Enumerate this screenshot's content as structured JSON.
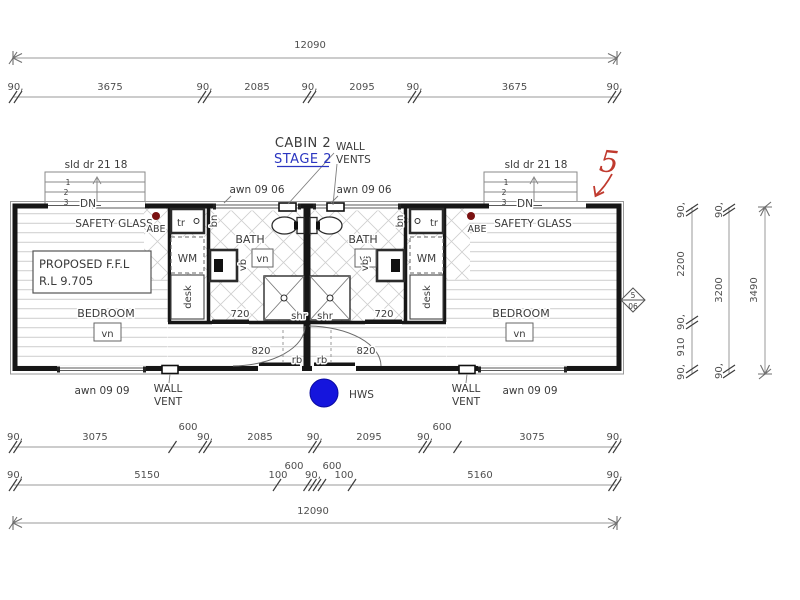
{
  "colors": {
    "stage_blue": "#2a35c0",
    "markup_red": "#c03a2e",
    "abe_dot": "#7a1111",
    "hws_blue": "#1515dd"
  },
  "dims": {
    "top_overall": "12090",
    "bottom_overall": "12090",
    "top_row": [
      "90,",
      "3675",
      "90,",
      "2085",
      "90,",
      "2095",
      "90,",
      "3675",
      "90,"
    ],
    "bottom_row1": [
      "90,",
      "3075",
      "600",
      "90,",
      "2085",
      "90,",
      "2095",
      "90,",
      "600",
      "3075",
      "90,"
    ],
    "bottom_row2": [
      "90,",
      "5150",
      "600",
      "100",
      "90,",
      "100",
      "600",
      "5160",
      "90,"
    ],
    "right_col_inner": [
      "90,",
      "2200",
      "90,",
      "910",
      "90,"
    ],
    "right_col_mid": [
      "90,",
      "3200",
      "90,"
    ],
    "right_overall": "3490"
  },
  "plan": {
    "title": "CABIN 2",
    "stage": "STAGE 2",
    "wall_vents_label": [
      "WALL",
      "VENTS"
    ],
    "sliding_door_label": "sld dr 21 18",
    "awning_top_label": "awn 09 06",
    "awning_bottom_label": "awn 09 09",
    "wall_vent_label": [
      "WALL",
      "VENT"
    ],
    "safety_glass": "SAFETY GLASS",
    "abe": "ABE",
    "down": "DN",
    "steps": [
      "1",
      "2",
      "3"
    ],
    "ffl_line1": "PROPOSED F.F.L",
    "ffl_line2": "R.L 9.705",
    "bedroom": "BEDROOM",
    "bath": "BATH",
    "hws": "HWS",
    "vent_note": "vn",
    "basin_note": "vb",
    "bin_note": "bn",
    "trough_note": "tr",
    "washer_note": "WM",
    "desk_note": "desk",
    "shower_note": "shr",
    "robe_note": "rb",
    "bath_door_width": "720",
    "entry_door_width": "820",
    "red_markup": "5",
    "section_ref_top": "5",
    "section_ref_bottom": "06"
  }
}
